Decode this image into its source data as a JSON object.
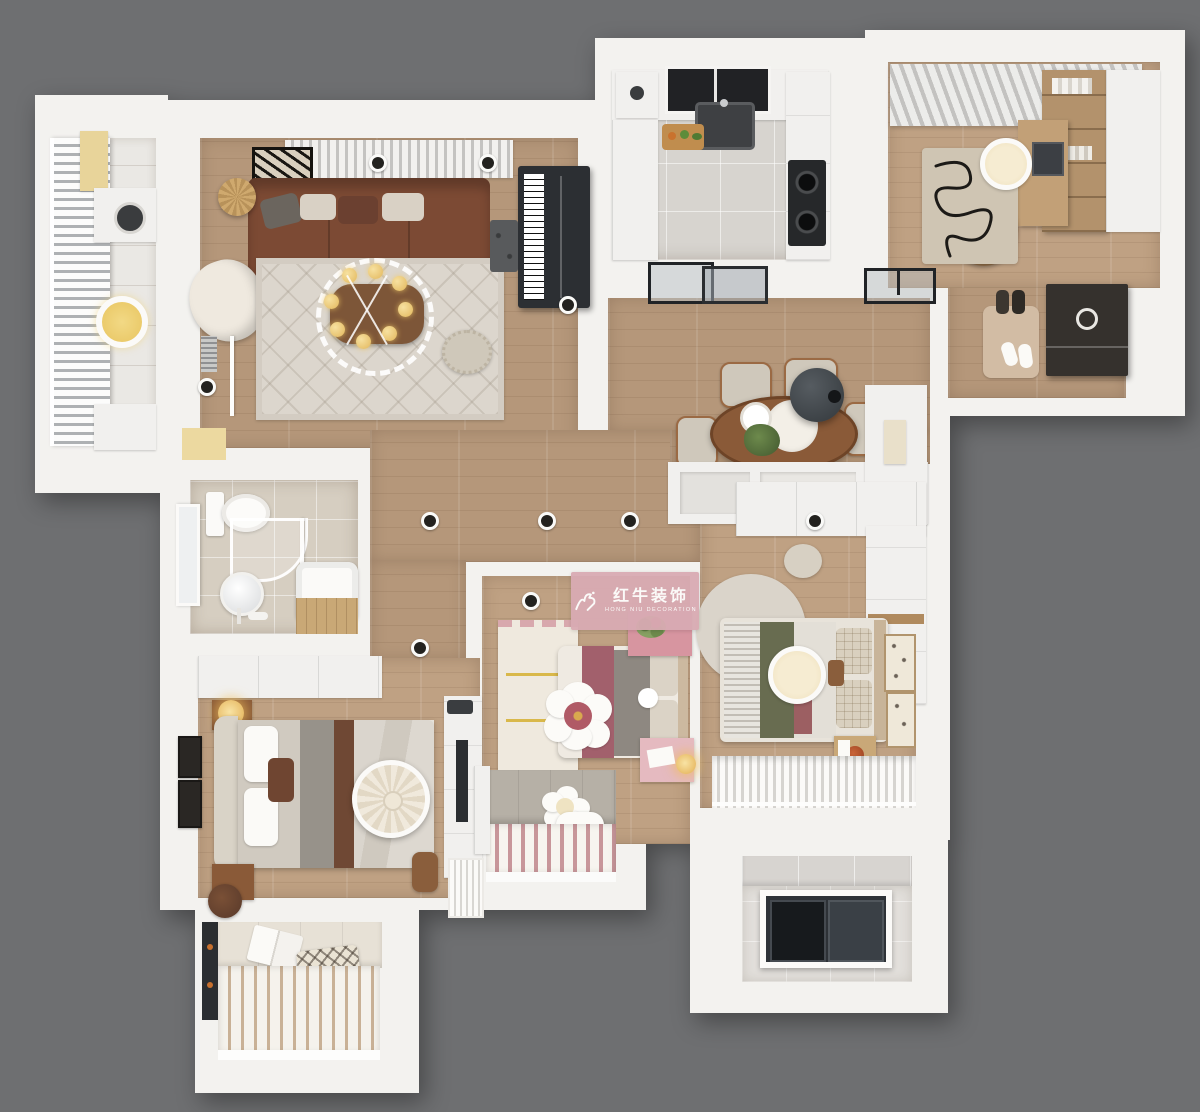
{
  "watermark": {
    "brand_cn": "红牛装饰",
    "brand_en": "HONG NIU DECORATION"
  },
  "rooms": [
    "balcony",
    "living-room",
    "kitchen",
    "study",
    "entry-foyer",
    "dining-area",
    "bathroom",
    "hallway",
    "master-bedroom",
    "kids-bedroom",
    "second-bedroom",
    "utility-balcony",
    "bay-window-nook"
  ],
  "colors": {
    "bg": "#6e6f71",
    "wall": "#f3f2ef",
    "wood": "#b5977a",
    "wood2": "#bfa183",
    "kitchenTile": "#d7d4cf",
    "bathTile": "#d6cec1",
    "balconyTile": "#eae8e4",
    "utilityTile": "#e2dfdb",
    "rug": "#dcd6cd",
    "sofa": "#7c4a34",
    "sofaDark": "#6b4030",
    "woodFurn": "#8a5a38",
    "piano": "#2c2f33",
    "glassDark": "#26292d",
    "warmLight": "#f2d27a",
    "mauve": "#a2606c",
    "olive": "#686c50",
    "pink": "#d795a0",
    "pinkStripe": "#c8969a",
    "wmPink": "#d9abb3",
    "cream": "#d9d1c5",
    "graycloth": "#97928a"
  }
}
